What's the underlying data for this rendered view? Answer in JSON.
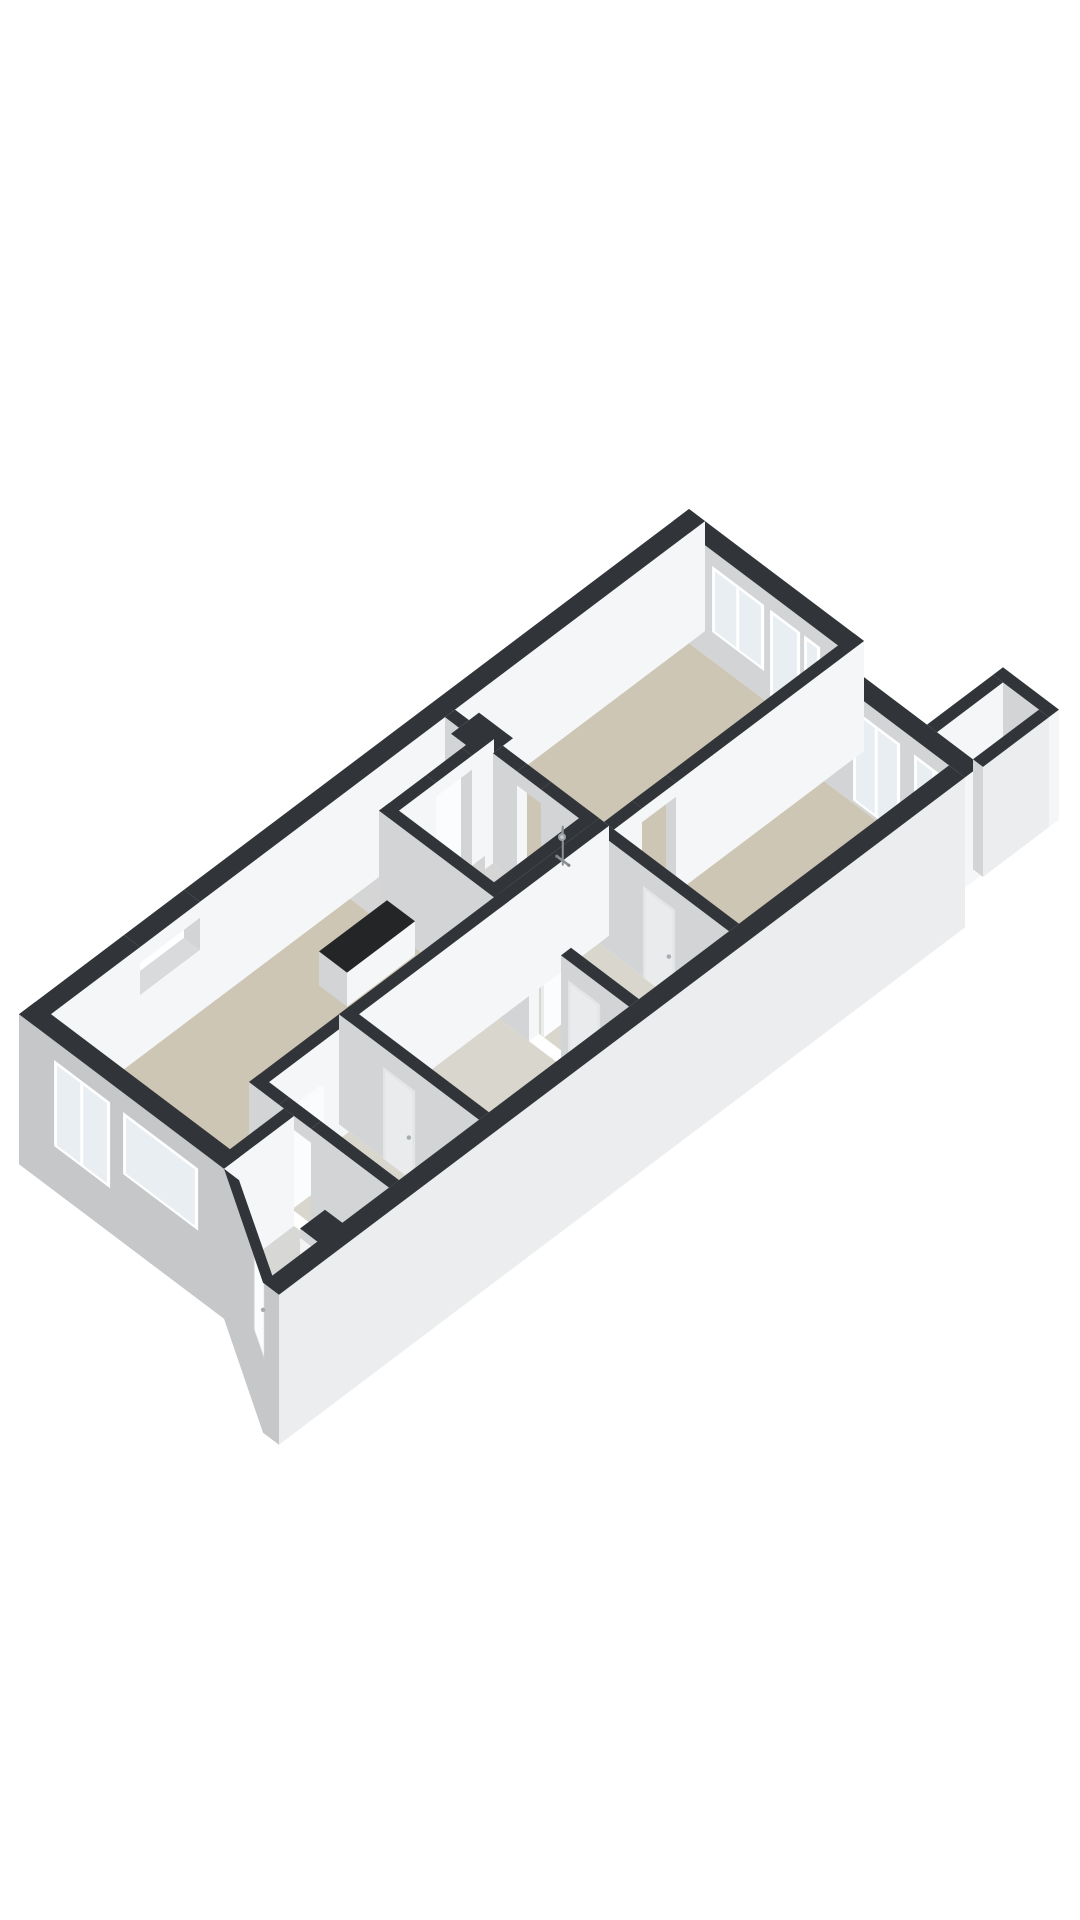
{
  "scene": {
    "background": "#ffffff",
    "projection": {
      "ox": 689,
      "oy": 619,
      "scale": 1,
      "ratio": 0.754,
      "wallHeight": 110
    },
    "palette": {
      "topDark": "#313539",
      "topLight": "#d9dadc",
      "topWhite": "#fafbfc",
      "topGlass": "#e8ecef",
      "wallBright": "#f5f6f8",
      "wallGray": "#d2d4d6",
      "facadeGray": "#c5c7c9",
      "facadeLight": "#ebedee",
      "doorBright": "#fbfcfd",
      "doorGray": "#e9ebed",
      "beige": "#cec6b5",
      "beigeLight": "#d9d6cd",
      "grayFloor": "#d4d5d4",
      "grayFloor2": "#d7d7d5",
      "bumpFloor": "#d0d1d2",
      "glass": "#e9eef2",
      "frame": "#ffffff",
      "flameOrange": "#e07c22",
      "flameYellow": "#f6bc3f",
      "fireboxDark": "#1c130c",
      "fireboxGlow": "#46260f",
      "counterTop": "#232527",
      "red": "#c23a2c",
      "fixture": "#8b9195"
    },
    "floors": [
      {
        "id": "living-top",
        "color": "beige",
        "pts": [
          [
            16,
            16
          ],
          [
            165,
            16
          ],
          [
            165,
            250
          ],
          [
            16,
            250
          ]
        ]
      },
      {
        "id": "room-topright",
        "color": "beige",
        "pts": [
          [
            175,
            40
          ],
          [
            300,
            40
          ],
          [
            300,
            250
          ],
          [
            175,
            250
          ]
        ]
      },
      {
        "id": "room-middle",
        "color": "beigeLight",
        "pts": [
          [
            170,
            260
          ],
          [
            300,
            260
          ],
          [
            300,
            350
          ],
          [
            170,
            350
          ]
        ]
      },
      {
        "id": "bedroom-a",
        "color": "beigeLight",
        "pts": [
          [
            170,
            360
          ],
          [
            300,
            360
          ],
          [
            300,
            500
          ],
          [
            170,
            500
          ]
        ]
      },
      {
        "id": "bedroom-b",
        "color": "beigeLight",
        "pts": [
          [
            170,
            510
          ],
          [
            300,
            510
          ],
          [
            300,
            590
          ],
          [
            170,
            590
          ]
        ]
      },
      {
        "id": "hallway",
        "color": "grayFloor",
        "pts": [
          [
            16,
            260
          ],
          [
            45,
            260
          ],
          [
            45,
            355
          ],
          [
            16,
            355
          ]
        ]
      },
      {
        "id": "bathroom",
        "color": "grayFloor",
        "pts": [
          [
            55,
            260
          ],
          [
            150,
            260
          ],
          [
            150,
            345
          ],
          [
            55,
            345
          ]
        ]
      },
      {
        "id": "living-left",
        "color": "beige",
        "pts": [
          [
            16,
            355
          ],
          [
            160,
            355
          ],
          [
            160,
            654
          ],
          [
            16,
            654
          ]
        ]
      },
      {
        "id": "entrance-hall",
        "color": "grayFloor2",
        "pts": [
          [
            170,
            600
          ],
          [
            300,
            600
          ],
          [
            300,
            724
          ],
          [
            221,
            677
          ],
          [
            170,
            648
          ]
        ]
      },
      {
        "id": "balcony",
        "color": "bumpFloor",
        "pts": [
          [
            272,
            -42
          ],
          [
            308,
            -42
          ],
          [
            308,
            24
          ],
          [
            272,
            24
          ]
        ]
      }
    ],
    "walls": [
      {
        "id": "exterior-nw-a",
        "layer": "back",
        "box": [
          0,
          0,
          16,
          505
        ],
        "h": 110,
        "top": "dark"
      },
      {
        "id": "exterior-nw-slit-sill",
        "layer": "back",
        "box": [
          0,
          505,
          16,
          565
        ],
        "h": 62,
        "top": "light"
      },
      {
        "id": "exterior-nw-slit-lintel",
        "layer": "back",
        "box": [
          0,
          505,
          16,
          565
        ],
        "z0": 94,
        "h": 16,
        "top": "dark"
      },
      {
        "id": "exterior-nw-b",
        "layer": "back",
        "box": [
          0,
          565,
          16,
          670
        ],
        "h": 110,
        "top": "dark"
      },
      {
        "id": "exterior-ne-1",
        "layer": "back",
        "box": [
          0,
          0,
          175,
          16
        ],
        "h": 110,
        "top": "dark",
        "decals": [
          {
            "face": "py",
            "kind": "glass2",
            "a0": 40,
            "a1": 92,
            "z0": 30,
            "z1": 96
          },
          {
            "face": "py",
            "kind": "glass1",
            "a0": 98,
            "a1": 128,
            "z0": 6,
            "z1": 96
          },
          {
            "face": "py",
            "kind": "glass1",
            "a0": 132,
            "a1": 148,
            "z0": 30,
            "z1": 96
          }
        ]
      },
      {
        "id": "exterior-ne-2",
        "layer": "back",
        "box": [
          175,
          24,
          316,
          40
        ],
        "h": 110,
        "top": "dark",
        "decals": [
          {
            "face": "py",
            "kind": "glass2",
            "a0": 205,
            "a1": 252,
            "z0": 4,
            "z1": 96
          },
          {
            "face": "py",
            "kind": "glass2",
            "a0": 266,
            "a1": 306,
            "z0": 4,
            "z1": 96
          }
        ]
      },
      {
        "id": "balcony-wall-ne",
        "layer": "back",
        "box": [
          262,
          -52,
          318,
          -42
        ],
        "h": 110,
        "top": "dark"
      },
      {
        "id": "balcony-wall-nw",
        "layer": "back",
        "box": [
          262,
          -42,
          272,
          24
        ],
        "h": 110,
        "top": "dark"
      },
      {
        "id": "balcony-wall-se",
        "layer": "back",
        "box": [
          308,
          -42,
          318,
          24
        ],
        "h": 110,
        "top": "dark",
        "bright": "facadeLight"
      },
      {
        "id": "divider-v1-a",
        "layer": "mid",
        "box": [
          165,
          0,
          175,
          188
        ],
        "h": 110,
        "top": "dark"
      },
      {
        "id": "divider-v1-lintel",
        "layer": "mid",
        "box": [
          165,
          188,
          175,
          222
        ],
        "z0": 96,
        "h": 14,
        "top": "dark"
      },
      {
        "id": "divider-v1-b",
        "layer": "mid",
        "box": [
          165,
          222,
          175,
          250
        ],
        "h": 110,
        "top": "dark"
      },
      {
        "id": "wall-living-a",
        "layer": "mid",
        "box": [
          16,
          250,
          30,
          260
        ],
        "h": 110,
        "top": "dark"
      },
      {
        "id": "fireplace-chimney",
        "layer": "mid",
        "box": [
          30,
          240,
          64,
          268
        ],
        "h": 110,
        "top": "dark",
        "decals": [
          {
            "face": "px",
            "kind": "firebox",
            "a0": 243,
            "a1": 263,
            "z0": 32,
            "z1": 80
          }
        ]
      },
      {
        "id": "wall-living-b",
        "layer": "mid",
        "box": [
          64,
          250,
          88,
          260
        ],
        "h": 110,
        "top": "dark"
      },
      {
        "id": "wall-living-lintel",
        "layer": "mid",
        "box": [
          88,
          250,
          112,
          260
        ],
        "z0": 96,
        "h": 14,
        "top": "dark"
      },
      {
        "id": "wall-living-c",
        "layer": "mid",
        "box": [
          112,
          250,
          160,
          260
        ],
        "h": 110,
        "top": "dark"
      },
      {
        "id": "wall-room-middle",
        "layer": "mid",
        "box": [
          170,
          250,
          300,
          260
        ],
        "h": 110,
        "top": "dark",
        "decals": [
          {
            "face": "py",
            "kind": "door",
            "a0": 215,
            "a1": 247,
            "z0": 0,
            "z1": 92
          }
        ]
      },
      {
        "id": "bath-wall-left-a",
        "layer": "mid",
        "box": [
          45,
          250,
          55,
          272
        ],
        "h": 110,
        "top": "dark"
      },
      {
        "id": "bath-door-lintel",
        "layer": "mid",
        "box": [
          45,
          272,
          55,
          308
        ],
        "z0": 96,
        "h": 14,
        "top": "dark"
      },
      {
        "id": "bath-wall-left-b",
        "layer": "mid",
        "box": [
          45,
          308,
          55,
          355
        ],
        "h": 110,
        "top": "dark"
      },
      {
        "id": "bath-wall-right",
        "layer": "mid",
        "box": [
          150,
          250,
          160,
          355
        ],
        "h": 110,
        "top": "dark"
      },
      {
        "id": "bath-wall-bottom",
        "layer": "mid",
        "box": [
          45,
          345,
          160,
          355
        ],
        "h": 110,
        "top": "dark"
      },
      {
        "id": "divider-v2",
        "layer": "mid",
        "box": [
          160,
          250,
          170,
          600
        ],
        "h": 110,
        "top": "dark"
      },
      {
        "id": "wall-350-a",
        "layer": "mid",
        "box": [
          160,
          350,
          200,
          360
        ],
        "h": 110,
        "top": "dark"
      },
      {
        "id": "wall-350-lintel",
        "layer": "mid",
        "box": [
          200,
          350,
          232,
          360
        ],
        "z0": 96,
        "h": 14,
        "top": "dark"
      },
      {
        "id": "wall-350-b",
        "layer": "mid",
        "box": [
          232,
          350,
          300,
          360
        ],
        "h": 110,
        "top": "dark",
        "decals": [
          {
            "face": "py",
            "kind": "door",
            "a0": 240,
            "a1": 272,
            "z0": 0,
            "z1": 92
          }
        ]
      },
      {
        "id": "wall-500",
        "layer": "mid",
        "box": [
          160,
          500,
          300,
          510
        ],
        "h": 110,
        "top": "dark",
        "decals": [
          {
            "face": "py",
            "kind": "door",
            "a0": 205,
            "a1": 237,
            "z0": 0,
            "z1": 92
          }
        ]
      },
      {
        "id": "wall-590-a",
        "layer": "mid",
        "box": [
          160,
          590,
          190,
          600
        ],
        "h": 110,
        "top": "dark"
      },
      {
        "id": "wall-590-lintel",
        "layer": "mid",
        "box": [
          190,
          590,
          222,
          600
        ],
        "z0": 96,
        "h": 14,
        "top": "dark"
      },
      {
        "id": "wall-590-b",
        "layer": "mid",
        "box": [
          222,
          590,
          300,
          600
        ],
        "h": 110,
        "top": "dark"
      },
      {
        "id": "kitchen-counter",
        "layer": "mid",
        "box": [
          58,
          360,
          86,
          428
        ],
        "h": 34,
        "top": "black"
      },
      {
        "id": "meter-cupboard",
        "layer": "mid",
        "box": [
          276,
          640,
          300,
          665
        ],
        "h": 100,
        "top": "dark",
        "decals": [
          {
            "face": "py",
            "kind": "meter",
            "a0": 277,
            "a1": 299,
            "z0": 8,
            "z1": 92
          }
        ]
      },
      {
        "id": "door-leaf-bathroom",
        "layer": "mid",
        "box": [
          41,
          272,
          44,
          306
        ],
        "h": 98,
        "top": "white",
        "bright": "doorBright",
        "gray": "doorGray"
      },
      {
        "id": "door-leaf-room-a",
        "layer": "mid",
        "box": [
          202,
          318,
          205,
          350
        ],
        "h": 98,
        "top": "white",
        "bright": "doorBright",
        "gray": "doorGray"
      },
      {
        "id": "door-leaf-room-b",
        "layer": "mid",
        "box": [
          190,
          558,
          193,
          590
        ],
        "h": 98,
        "top": "white",
        "bright": "doorBright",
        "gray": "doorGray"
      },
      {
        "id": "shower-glass-screen",
        "layer": "mid",
        "box": [
          146,
          260,
          149,
          322
        ],
        "h": 95,
        "top": "glass",
        "opacity": 0.5
      },
      {
        "id": "entrance-left-wall",
        "layer": "mid",
        "box": [
          195,
          600,
          205,
          670
        ],
        "h": 110,
        "top": "dark"
      },
      {
        "id": "exterior-se",
        "layer": "front",
        "box": [
          300,
          40,
          316,
          726
        ],
        "z0": -40,
        "h": 150,
        "top": "dark",
        "bright": "facadeLight"
      },
      {
        "id": "exterior-sw",
        "layer": "front",
        "box": [
          0,
          654,
          205,
          670
        ],
        "z0": -40,
        "h": 150,
        "top": "dark",
        "gray": "facadeGray",
        "decals": [
          {
            "face": "py",
            "kind": "glass2",
            "a0": 36,
            "a1": 92,
            "z0": 6,
            "z1": 92
          },
          {
            "face": "py",
            "kind": "glass1",
            "a0": 105,
            "a1": 180,
            "z0": 30,
            "z1": 92
          }
        ]
      },
      {
        "id": "entrance-diagonal-wall",
        "layer": "front",
        "pts": [
          [
            205,
            670
          ],
          [
            220,
            670
          ],
          [
            316,
            726
          ],
          [
            300,
            726
          ]
        ],
        "z0": -40,
        "h": 150,
        "top": "dark",
        "gray": "facadeGray",
        "decals": [
          {
            "face": "edge",
            "edge": 1,
            "kind": "door",
            "t0": 0.34,
            "t1": 0.6,
            "z0": 0,
            "z1": 96
          }
        ]
      }
    ],
    "flame": {
      "outer": [
        [
          0.15,
          0.08
        ],
        [
          0.22,
          0.62
        ],
        [
          0.34,
          0.35
        ],
        [
          0.45,
          0.85
        ],
        [
          0.56,
          0.42
        ],
        [
          0.68,
          0.7
        ],
        [
          0.82,
          0.3
        ],
        [
          0.88,
          0.08
        ]
      ],
      "inner": [
        [
          0.35,
          0.1
        ],
        [
          0.42,
          0.5
        ],
        [
          0.5,
          0.3
        ],
        [
          0.58,
          0.55
        ],
        [
          0.66,
          0.12
        ]
      ]
    },
    "shower": {
      "x": 133,
      "wallY": 259.2,
      "pipeZ0": 50,
      "pipeZ1": 88,
      "armTo": {
        "x": 137,
        "y": 264,
        "z": 85.5
      },
      "head": {
        "x": 137.5,
        "y": 264.5,
        "z": 85,
        "r": 4
      },
      "mixer": {
        "x0": 127,
        "x1": 139,
        "z": 54
      }
    }
  }
}
